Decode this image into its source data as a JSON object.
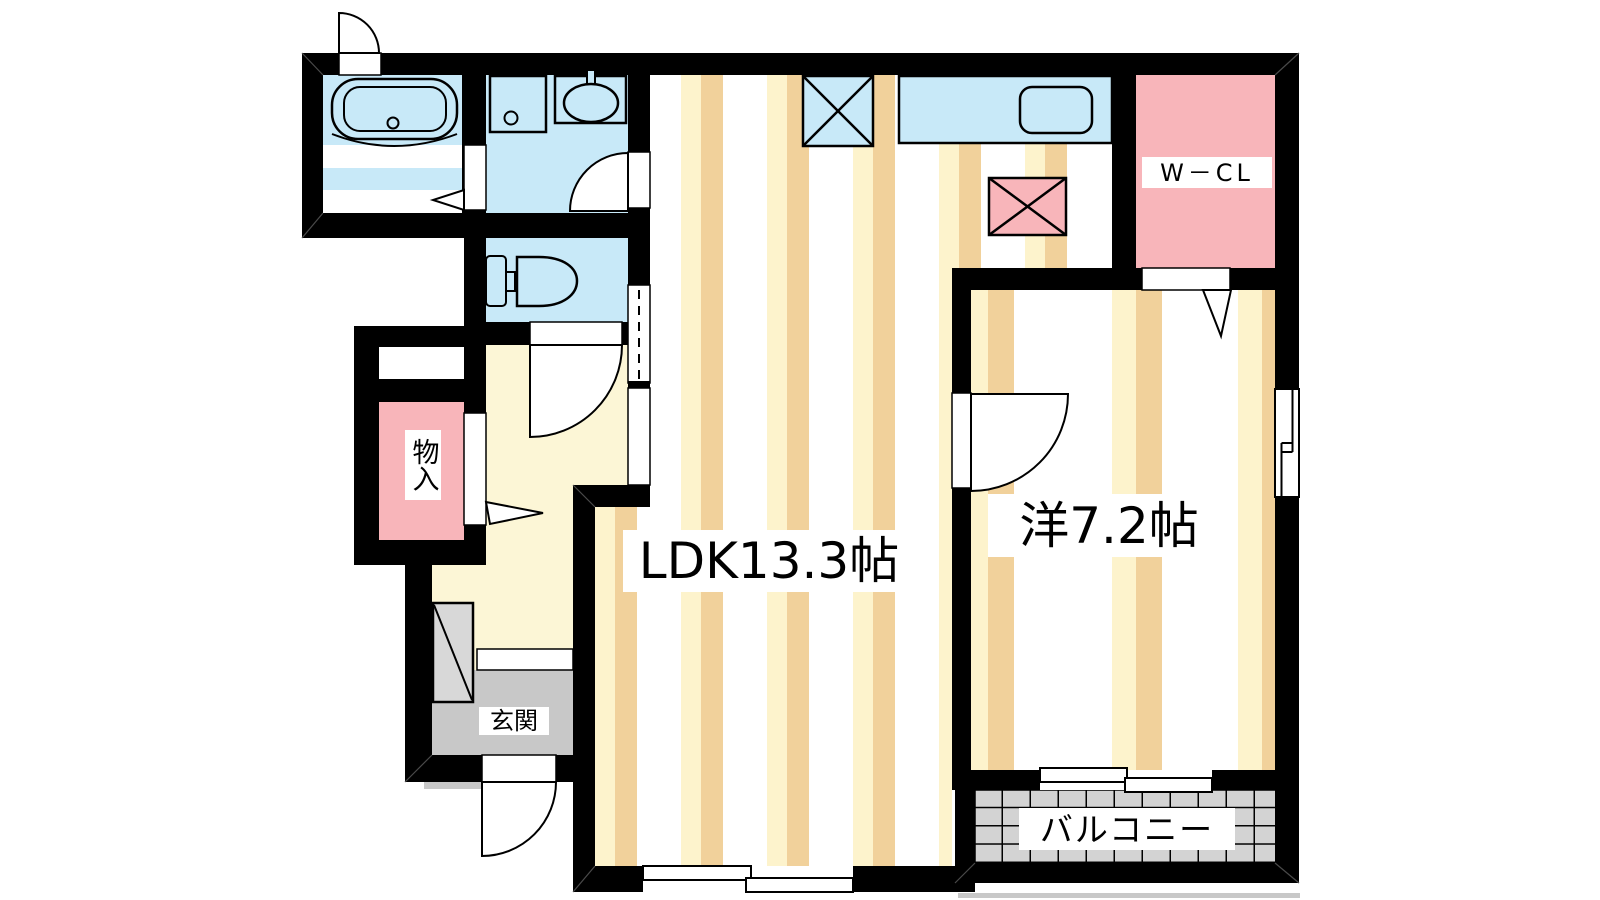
{
  "plan": {
    "rooms": {
      "ldk": {
        "label": "LDK13.3帖"
      },
      "western_room": {
        "label": "洋7.2帖"
      },
      "walk_in_closet": {
        "label": "W－CL"
      },
      "storage": {
        "label": "物入"
      },
      "entrance": {
        "label": "玄関"
      },
      "balcony": {
        "label": "バルコニー"
      }
    },
    "colors": {
      "wall": "#000000",
      "wet_area_blue": "#c8e9f8",
      "closet_pink": "#f8b5ba",
      "floor_stripe_cream": "#fdf3cc",
      "floor_stripe_tan": "#f1d19b",
      "hallway_yellow": "#fcf6d6",
      "entrance_gray": "#c8c8c8",
      "cabinet_gray": "#d8d8d8",
      "balcony_tile_gray": "#d3d3d3",
      "floor_base_white": "#ffffff"
    }
  }
}
